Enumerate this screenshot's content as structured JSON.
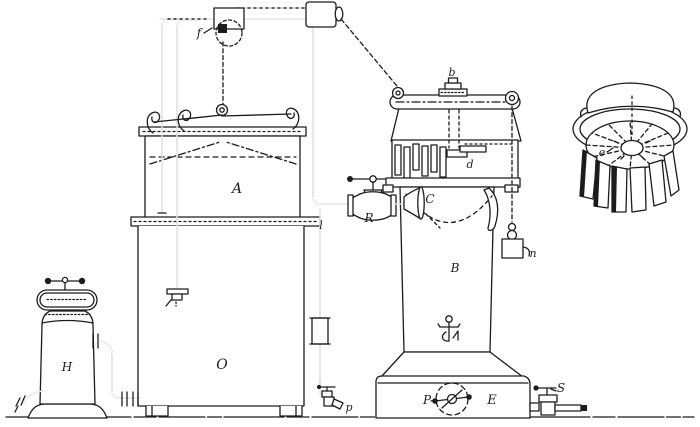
{
  "palette": {
    "ink": "#1c1c1c",
    "paper": "#ffffff"
  },
  "labels": {
    "f": "f",
    "A": "A",
    "O": "O",
    "H": "H",
    "l": "l",
    "R": "R",
    "C": "C",
    "b": "b",
    "d": "d",
    "B": "B",
    "n": "n",
    "e": "e",
    "p": "p",
    "P": "P",
    "E": "E",
    "S": "S"
  }
}
